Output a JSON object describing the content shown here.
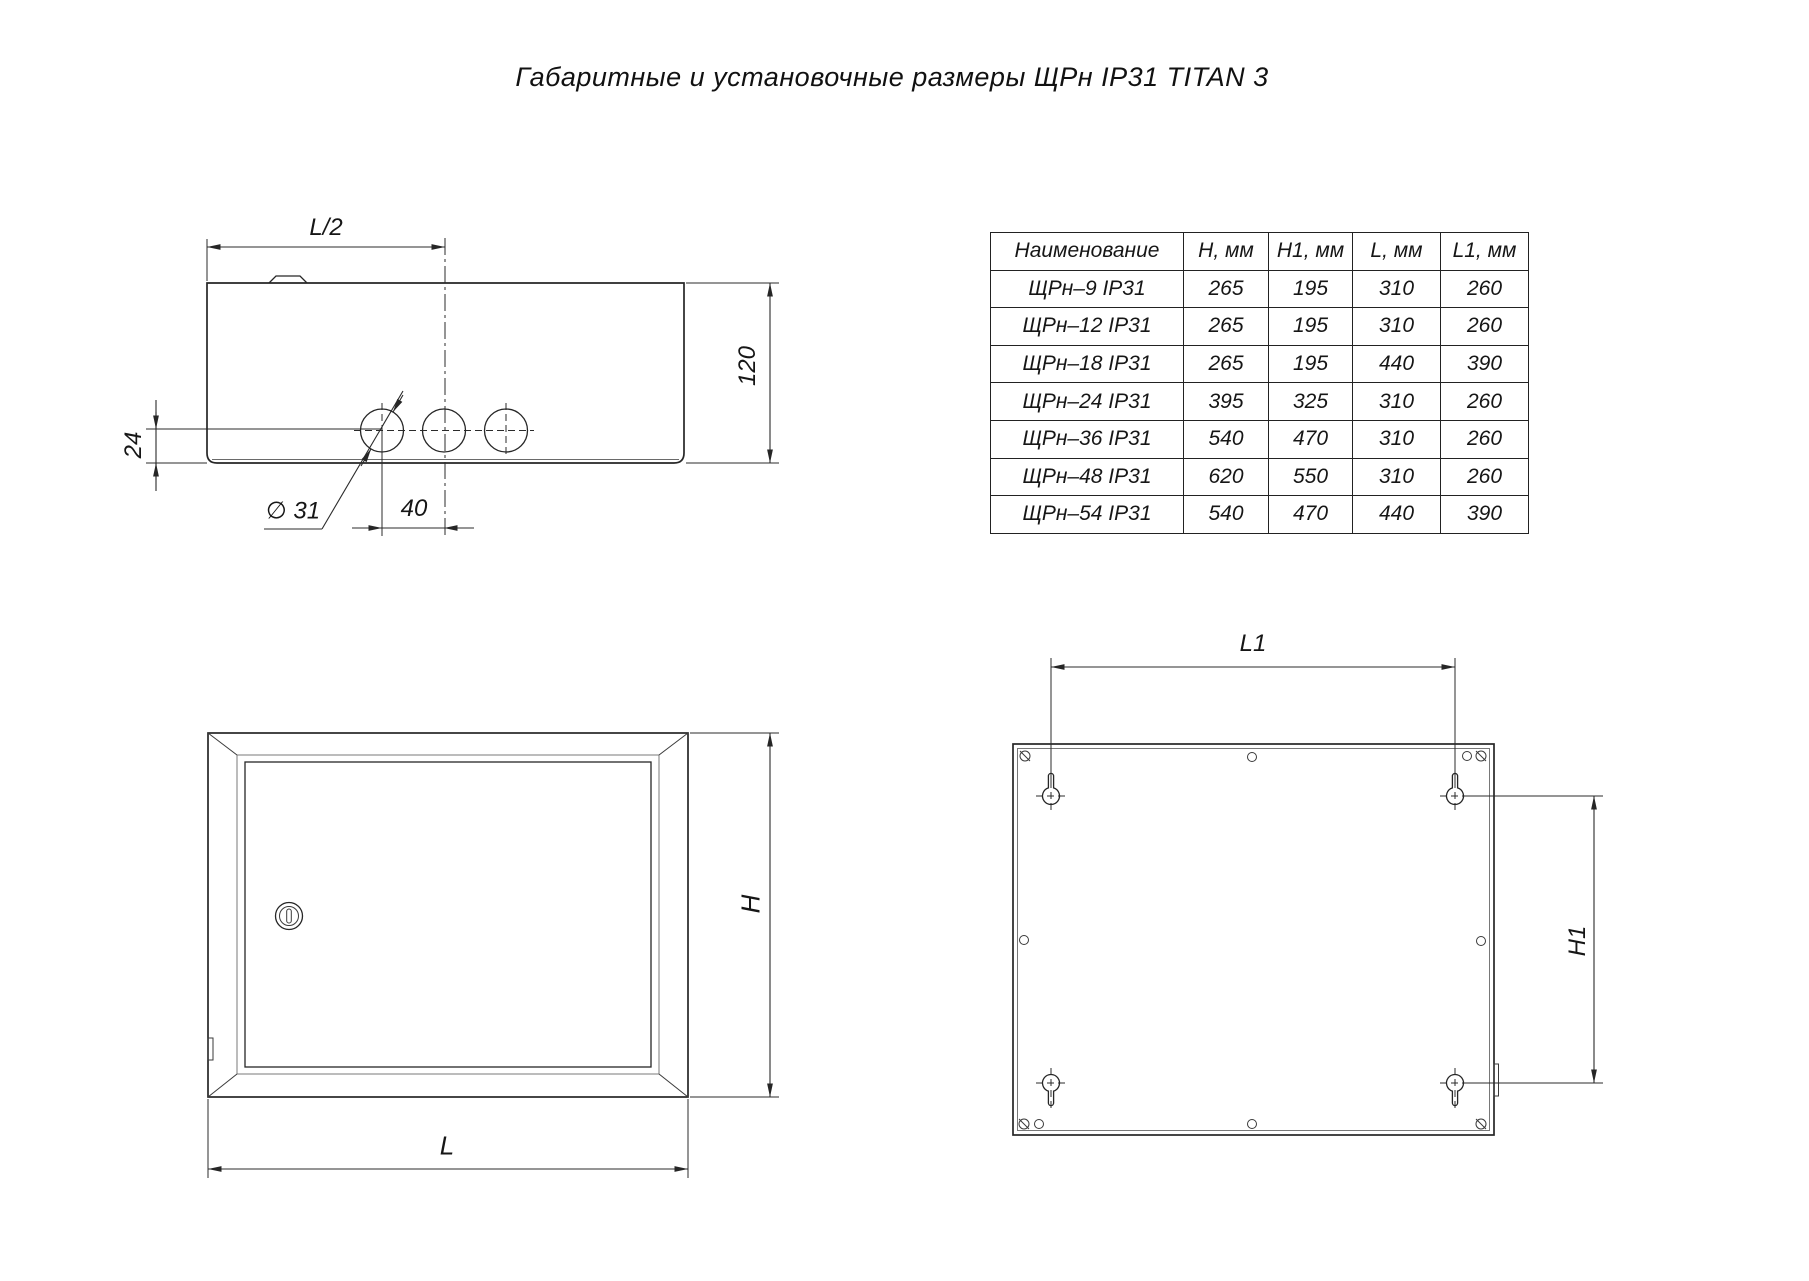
{
  "title": "Габаритные и установочные размеры ЩРн IP31 TITAN 3",
  "table": {
    "headers": [
      "Наименование",
      "H, мм",
      "H1, мм",
      "L, мм",
      "L1, мм"
    ],
    "rows": [
      [
        "ЩРн–9 IP31",
        "265",
        "195",
        "310",
        "260"
      ],
      [
        "ЩРн–12 IP31",
        "265",
        "195",
        "310",
        "260"
      ],
      [
        "ЩРн–18 IP31",
        "265",
        "195",
        "440",
        "390"
      ],
      [
        "ЩРн–24 IP31",
        "395",
        "325",
        "310",
        "260"
      ],
      [
        "ЩРн–36 IP31",
        "540",
        "470",
        "310",
        "260"
      ],
      [
        "ЩРн–48 IP31",
        "620",
        "550",
        "310",
        "260"
      ],
      [
        "ЩРн–54 IP31",
        "540",
        "470",
        "440",
        "390"
      ]
    ]
  },
  "dim_labels": {
    "half_width": "L/2",
    "depth": "120",
    "hole_offset": "24",
    "hole_diameter": "∅ 31",
    "hole_spacing": "40",
    "front_height": "H",
    "front_width": "L",
    "mount_width": "L1",
    "mount_height": "H1"
  }
}
